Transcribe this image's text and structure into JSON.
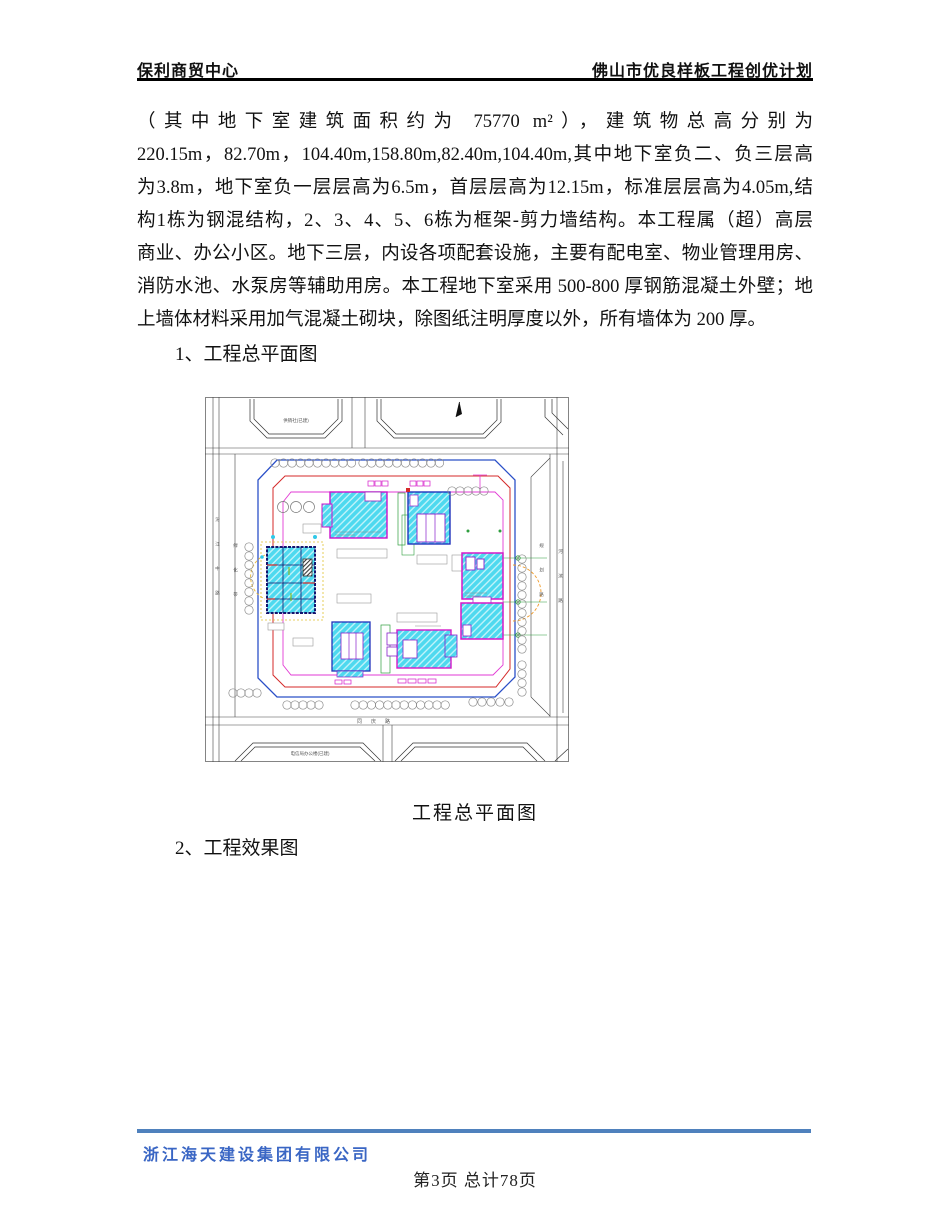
{
  "header": {
    "left": "保利商贸中心",
    "right": "佛山市优良样板工程创优计划"
  },
  "paragraph": {
    "lines": [
      "（其中地下室建筑面积约为 75770 m²），建筑物总高分别为",
      "220.15m，82.70m，104.40m,158.80m,82.40m,104.40m,其中地下室负二、负三层高",
      "为3.8m，地下室负一层层高为6.5m，首层层高为12.15m，标准层层高为4.05m,结",
      "构1栋为钢混结构，2、3、4、5、6栋为框架-剪力墙结构。本工程属（超）高层",
      "商业、办公小区。地下三层，内设各项配套设施，主要有配电室、物业管理用房、",
      "消防水池、水泵房等辅助用房。本工程地下室采用 500-800 厚钢筋混凝土外壁；地",
      "上墙体材料采用加气混凝土砌块，除图纸注明厚度以外，所有墙体为 200 厚。"
    ]
  },
  "sections": {
    "item1": "1、工程总平面图",
    "item2": "2、工程效果图"
  },
  "figure": {
    "caption": "工程总平面图",
    "labels": {
      "block_top_left": "供销社(已建)",
      "block_bottom": "电信局办公楼(已建)",
      "road_bottom": "同庆路",
      "road_left_outer": "汾江中路",
      "road_left_inner": "绿化带",
      "road_right_outer": "规划路",
      "road_right_inner": "河滨路"
    },
    "colors": {
      "building_fill": "#4ED9EF",
      "outline_magenta": "#D619C9",
      "outline_blue": "#2233BB",
      "boundary_blue": "#2B50C8",
      "boundary_red": "#D42A2A",
      "boundary_magenta": "#E23AD4",
      "green": "#2E9E3E",
      "orange": "#F09A28",
      "yellow": "#E0C030"
    }
  },
  "footer": {
    "company": "浙江海天建设集团有限公司",
    "page_info": "第3页 总计78页",
    "line_color": "#4F81BD",
    "company_color": "#3A66C4"
  }
}
